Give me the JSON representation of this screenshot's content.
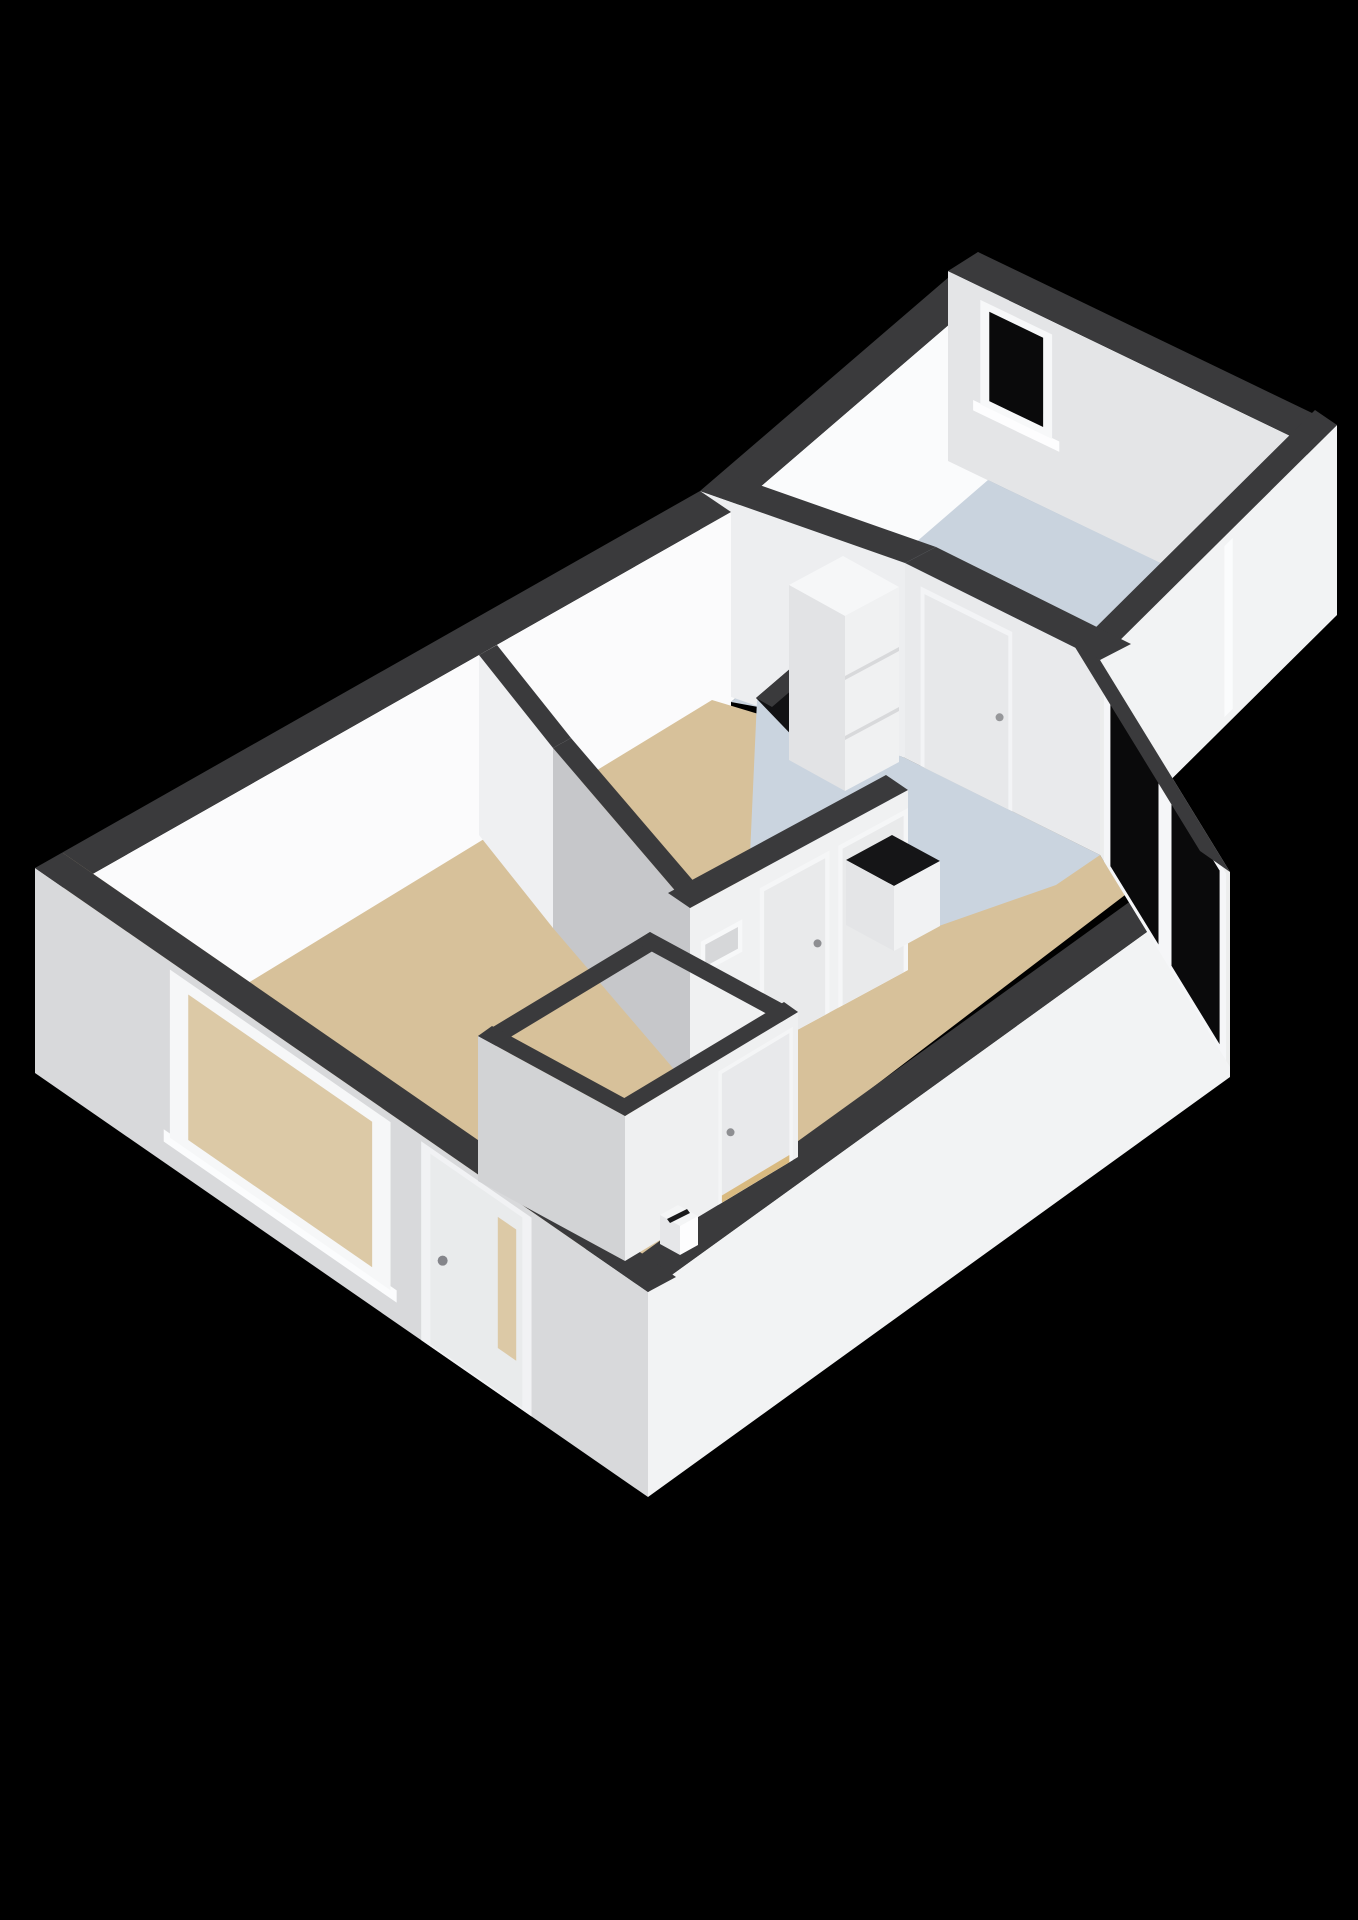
{
  "canvas": {
    "width": 1358,
    "height": 1920,
    "background": "#000000"
  },
  "palette": {
    "wall_cut_band": "#3a3a3c",
    "wall_white_bright": "#fbfbfc",
    "wall_white": "#f2f3f4",
    "wall_gray_light": "#e4e5e7",
    "wall_gray_mid": "#c6c7ca",
    "floor_living_beige": "#d7c19a",
    "floor_kitchen_blue": "#cad4df",
    "floor_bedroom_blue": "#c9d3de",
    "floor_bathroom_dark": "#121214",
    "glass_dark": "#0a0a0b",
    "glass_beige_reflection": "#dcc9a6",
    "counter_black": "#151517",
    "threshold_oak": "#d9ba80"
  },
  "scene": {
    "items": [
      {
        "name": "background",
        "type": "poly",
        "fill": "#000000",
        "points": [
          [
            0,
            0
          ],
          [
            1358,
            0
          ],
          [
            1358,
            1920
          ],
          [
            0,
            1920
          ]
        ]
      },
      {
        "name": "bedroom-wall-nw",
        "type": "wall",
        "edge": [
          [
            700,
            491
          ],
          [
            978,
            252
          ]
        ],
        "band": [
          31,
          21
        ],
        "drop": 190,
        "faceEdge": "inner",
        "face": "#fafbfc"
      },
      {
        "name": "bedroom-wall-ne",
        "type": "wall",
        "edge": [
          [
            978,
            252
          ],
          [
            1337,
            425
          ]
        ],
        "band": [
          -30,
          19
        ],
        "drop": 190,
        "faceEdge": "inner",
        "face": "#e4e5e7",
        "decals": [
          {
            "kind": "quad",
            "name": "bedroom-window-sill",
            "u0": 0.07,
            "u1": 0.31,
            "z0": 0.33,
            "z1": 0.385,
            "fill": "#fdfdfe"
          },
          {
            "kind": "quad",
            "name": "bedroom-window-frame",
            "u0": 0.09,
            "u1": 0.29,
            "z0": 0.38,
            "z1": 0.93,
            "fill": "#f7f8f9"
          },
          {
            "kind": "quad",
            "name": "bedroom-window-glass",
            "u0": 0.115,
            "u1": 0.265,
            "z0": 0.42,
            "z1": 0.89,
            "fill": "#0a0a0b"
          }
        ]
      },
      {
        "name": "bedroom-floor",
        "type": "poly",
        "fill": "#c9d3de",
        "points": [
          [
            731,
            702
          ],
          [
            988,
            480
          ],
          [
            1300,
            630
          ],
          [
            1115,
            835
          ],
          [
            940,
            740
          ]
        ]
      },
      {
        "name": "bedroom-wall-se",
        "type": "wall",
        "edge": [
          [
            1337,
            425
          ],
          [
            1100,
            660
          ]
        ],
        "band": [
          -22,
          -15
        ],
        "drop": 190,
        "faceEdge": "outer",
        "face": "#f2f3f4",
        "decals": [
          {
            "kind": "quad",
            "name": "bedroom-exterior-door-seam",
            "u0": 0.44,
            "u1": 0.475,
            "z0": 0.05,
            "z1": 0.95,
            "fill": "#fbfcfd"
          }
        ]
      },
      {
        "name": "bedroom-wall-sw",
        "type": "wall",
        "edge": [
          [
            700,
            491
          ],
          [
            905,
            563
          ]
        ],
        "band": [
          31,
          -16
        ],
        "drop": 195,
        "faceEdge": "outer",
        "face": "#edeef0"
      },
      {
        "name": "main-wall-nw",
        "type": "wall",
        "edge": [
          [
            35,
            868
          ],
          [
            700,
            491
          ]
        ],
        "band": [
          31,
          21
        ],
        "drop": 205,
        "faceEdge": "inner",
        "face": "#fbfbfc"
      },
      {
        "name": "living-room-floor",
        "type": "poly",
        "fill": "#d7c19a",
        "points": [
          [
            66,
            1094
          ],
          [
            712,
            700
          ],
          [
            905,
            758
          ],
          [
            1100,
            855
          ],
          [
            1125,
            895
          ],
          [
            640,
            1265
          ]
        ]
      },
      {
        "name": "living-room-floor-edge",
        "type": "poly",
        "fill": "#d7c19a",
        "points": [
          [
            66,
            1094
          ],
          [
            640,
            1265
          ],
          [
            676,
            1277
          ],
          [
            63,
            853
          ]
        ]
      },
      {
        "name": "kitchen-floor",
        "type": "poly",
        "fill": "#cad4df",
        "points": [
          [
            757,
            700
          ],
          [
            905,
            758
          ],
          [
            1100,
            855
          ],
          [
            1056,
            885
          ],
          [
            856,
            955
          ],
          [
            750,
            855
          ]
        ]
      },
      {
        "name": "bathroom-floor",
        "type": "poly",
        "fill": "#121214",
        "points": [
          [
            756,
            698
          ],
          [
            812,
            650
          ],
          [
            850,
            700
          ],
          [
            806,
            750
          ]
        ]
      },
      {
        "name": "main-wall-se",
        "type": "wall",
        "edge": [
          [
            1230,
            872
          ],
          [
            648,
            1292
          ]
        ],
        "band": [
          -30,
          -21
        ],
        "drop": 205,
        "faceEdge": "outer",
        "face": "#f2f3f4"
      },
      {
        "name": "main-wall-sw",
        "type": "wall",
        "edge": [
          [
            35,
            868
          ],
          [
            648,
            1292
          ]
        ],
        "band": [
          28,
          -15
        ],
        "drop": 205,
        "faceEdge": "outer",
        "face": "#d8d9db",
        "decals": [
          {
            "kind": "quad",
            "name": "living-window-sill",
            "u0": 0.21,
            "u1": 0.59,
            "z0": 0.1,
            "z1": 0.16,
            "fill": "#fbfcfd"
          },
          {
            "kind": "quad",
            "name": "living-window-frame",
            "u0": 0.22,
            "u1": 0.58,
            "z0": 0.14,
            "z1": 0.96,
            "fill": "#f6f7f8"
          },
          {
            "kind": "quad",
            "name": "living-window-glass",
            "u0": 0.25,
            "u1": 0.55,
            "z0": 0.19,
            "z1": 0.9,
            "fill": "#dcc9a6"
          },
          {
            "kind": "quad",
            "name": "front-door-frame",
            "u0": 0.63,
            "u1": 0.81,
            "z0": 0,
            "z1": 0.97,
            "fill": "#f1f2f4"
          },
          {
            "kind": "quad",
            "name": "front-door",
            "u0": 0.645,
            "u1": 0.795,
            "z0": 0.01,
            "z1": 0.94,
            "fill": "#e9ebec"
          },
          {
            "kind": "quad",
            "name": "front-door-glass",
            "u0": 0.755,
            "u1": 0.785,
            "z0": 0.22,
            "z1": 0.86,
            "fill": "#dcc9a6"
          },
          {
            "kind": "dot",
            "name": "front-door-handle",
            "u": 0.665,
            "z": 0.46,
            "r": 5,
            "fill": "#84858a"
          }
        ]
      },
      {
        "name": "vestibule-wall",
        "type": "wall",
        "edge": [
          [
            479,
            655
          ],
          [
            553,
            748
          ]
        ],
        "band": [
          18,
          -10
        ],
        "drop": 180,
        "faceEdge": "outer",
        "face": "#eff0f2"
      },
      {
        "name": "wc-wall-sw",
        "type": "wall",
        "edge": [
          [
            553,
            748
          ],
          [
            690,
            908
          ]
        ],
        "band": [
          18,
          -10
        ],
        "drop": 180,
        "faceEdge": "outer",
        "face": "#c6c7ca"
      },
      {
        "name": "wc-wall-se",
        "type": "wall",
        "edge": [
          [
            690,
            908
          ],
          [
            908,
            790
          ]
        ],
        "band": [
          -22,
          -15
        ],
        "drop": 180,
        "faceEdge": "outer",
        "face": "#f0f1f2",
        "decals": [
          {
            "kind": "quad",
            "name": "wc-transom-frame",
            "u0": 0.05,
            "u1": 0.24,
            "z0": 0.6,
            "z1": 0.78,
            "fill": "#f7f8f9"
          },
          {
            "kind": "quad",
            "name": "wc-transom-glass",
            "u0": 0.07,
            "u1": 0.22,
            "z0": 0.63,
            "z1": 0.75,
            "fill": "#d6d7d9"
          },
          {
            "kind": "quad",
            "name": "wc-door-frame",
            "u0": 0.32,
            "u1": 0.64,
            "z0": 0,
            "z1": 0.9,
            "fill": "#f5f6f7"
          },
          {
            "kind": "quad",
            "name": "wc-door",
            "u0": 0.34,
            "u1": 0.62,
            "z0": 0,
            "z1": 0.87,
            "fill": "#e9eaeb"
          },
          {
            "kind": "dot",
            "name": "wc-door-handle",
            "u": 0.585,
            "z": 0.42,
            "r": 4,
            "fill": "#8e8f92"
          },
          {
            "kind": "quad",
            "name": "bathroom-door-frame",
            "u0": 0.68,
            "u1": 1.0,
            "z0": 0,
            "z1": 0.9,
            "fill": "#f5f6f7"
          },
          {
            "kind": "quad",
            "name": "bathroom-door",
            "u0": 0.7,
            "u1": 0.98,
            "z0": 0,
            "z1": 0.87,
            "fill": "#e9eaeb"
          },
          {
            "kind": "dot",
            "name": "bathroom-door-handle",
            "u": 0.945,
            "z": 0.42,
            "r": 4,
            "fill": "#8e8f92"
          }
        ]
      },
      {
        "name": "bathroom-divider-wall",
        "type": "wall",
        "edge": [
          [
            756,
            698
          ],
          [
            812,
            650
          ]
        ],
        "band": [
          16,
          9
        ],
        "drop": 0,
        "faceEdge": "outer",
        "face": null
      },
      {
        "name": "kitchen-bedroom-wall",
        "type": "wall",
        "edge": [
          [
            905,
            563
          ],
          [
            1100,
            660
          ]
        ],
        "band": [
          31,
          -16
        ],
        "drop": 195,
        "faceEdge": "outer",
        "face": "#e9eaec",
        "decals": [
          {
            "kind": "quad",
            "name": "bedroom-door-frame",
            "u0": 0.08,
            "u1": 0.55,
            "z0": 0,
            "z1": 0.92,
            "fill": "#f3f4f6"
          },
          {
            "kind": "quad",
            "name": "bedroom-door",
            "u0": 0.1,
            "u1": 0.53,
            "z0": 0,
            "z1": 0.89,
            "fill": "#e7e8ea"
          },
          {
            "kind": "dot",
            "name": "bedroom-door-handle",
            "u": 0.485,
            "z": 0.45,
            "r": 4,
            "fill": "#96979a"
          }
        ]
      },
      {
        "name": "balcony-glass-wall",
        "type": "wall",
        "edge": [
          [
            1100,
            660
          ],
          [
            1230,
            872
          ]
        ],
        "band": [
          -30,
          -21
        ],
        "drop": 195,
        "faceEdge": "outer",
        "face": "#eceded",
        "decals": [
          {
            "kind": "quad",
            "name": "balcony-door-frame",
            "u0": 0.03,
            "u1": 0.97,
            "z0": 0,
            "z1": 0.96,
            "fill": "#f5f6f8"
          },
          {
            "kind": "quad",
            "name": "balcony-glass-left",
            "u0": 0.08,
            "u1": 0.45,
            "z0": 0.03,
            "z1": 0.92,
            "fill": "#0a0a0b"
          },
          {
            "kind": "quad",
            "name": "balcony-glass-right",
            "u0": 0.55,
            "u1": 0.92,
            "z0": 0.03,
            "z1": 0.92,
            "fill": "#0a0a0b"
          }
        ]
      },
      {
        "name": "kitchen-cabinet-top",
        "type": "poly",
        "fill": "#f6f7f8",
        "points": [
          [
            789,
            585
          ],
          [
            843,
            556
          ],
          [
            899,
            587
          ],
          [
            845,
            616
          ]
        ]
      },
      {
        "name": "kitchen-cabinet-side",
        "type": "poly",
        "fill": "#e2e3e5",
        "points": [
          [
            789,
            585
          ],
          [
            845,
            616
          ],
          [
            845,
            791
          ],
          [
            789,
            760
          ]
        ]
      },
      {
        "name": "kitchen-cabinet-front",
        "type": "poly",
        "fill": "#f0f1f2",
        "points": [
          [
            845,
            616
          ],
          [
            899,
            587
          ],
          [
            899,
            762
          ],
          [
            845,
            791
          ]
        ]
      },
      {
        "name": "kitchen-cabinet-seam-upper",
        "type": "poly",
        "fill": "#d8d9db",
        "points": [
          [
            845,
            676
          ],
          [
            899,
            647
          ],
          [
            899,
            651
          ],
          [
            845,
            680
          ]
        ]
      },
      {
        "name": "kitchen-cabinet-seam-lower",
        "type": "poly",
        "fill": "#d8d9db",
        "points": [
          [
            845,
            736
          ],
          [
            899,
            707
          ],
          [
            899,
            711
          ],
          [
            845,
            740
          ]
        ]
      },
      {
        "name": "kitchen-counter-top",
        "type": "poly",
        "fill": "#151517",
        "points": [
          [
            846,
            860
          ],
          [
            892,
            835
          ],
          [
            940,
            861
          ],
          [
            894,
            886
          ]
        ]
      },
      {
        "name": "kitchen-counter-side",
        "type": "poly",
        "fill": "#e4e5e7",
        "points": [
          [
            846,
            860
          ],
          [
            894,
            886
          ],
          [
            894,
            951
          ],
          [
            846,
            925
          ]
        ]
      },
      {
        "name": "kitchen-counter-front",
        "type": "poly",
        "fill": "#f1f2f3",
        "points": [
          [
            894,
            886
          ],
          [
            940,
            861
          ],
          [
            940,
            926
          ],
          [
            894,
            951
          ]
        ]
      },
      {
        "name": "hall-wall-nw",
        "type": "wall",
        "edge": [
          [
            478,
            1036
          ],
          [
            650,
            932
          ]
        ],
        "band": [
          16,
          11
        ],
        "drop": 0,
        "faceEdge": "outer",
        "face": null
      },
      {
        "name": "hall-wall-ne",
        "type": "wall",
        "edge": [
          [
            650,
            932
          ],
          [
            798,
            1012
          ]
        ],
        "band": [
          -16,
          10
        ],
        "drop": 0,
        "faceEdge": "outer",
        "face": null
      },
      {
        "name": "hall-wall-se",
        "type": "wall",
        "edge": [
          [
            625,
            1116
          ],
          [
            798,
            1012
          ]
        ],
        "band": [
          -14,
          -10
        ],
        "drop": 145,
        "faceEdge": "outer",
        "face": "#eff0f1",
        "decals": [
          {
            "kind": "quad",
            "name": "hall-door-frame",
            "u0": 0.54,
            "u1": 0.97,
            "z0": 0,
            "z1": 0.92,
            "fill": "#f4f5f6"
          },
          {
            "kind": "quad",
            "name": "hall-door",
            "u0": 0.56,
            "u1": 0.95,
            "z0": 0.05,
            "z1": 0.89,
            "fill": "#e8e9eb"
          },
          {
            "kind": "quad",
            "name": "hall-door-threshold",
            "u0": 0.56,
            "u1": 0.95,
            "z0": 0,
            "z1": 0.05,
            "fill": "#d9ba80"
          },
          {
            "kind": "dot",
            "name": "hall-door-handle",
            "u": 0.61,
            "z": 0.45,
            "r": 4,
            "fill": "#8e8f92"
          }
        ]
      },
      {
        "name": "hall-wall-sw",
        "type": "wall",
        "edge": [
          [
            478,
            1036
          ],
          [
            625,
            1116
          ]
        ],
        "band": [
          14,
          -10
        ],
        "drop": 145,
        "faceEdge": "outer",
        "face": "#d2d3d5"
      },
      {
        "name": "letterbox-top",
        "type": "poly",
        "fill": "#f4f5f6",
        "points": [
          [
            660,
            1215
          ],
          [
            678,
            1205
          ],
          [
            698,
            1216
          ],
          [
            680,
            1226
          ]
        ]
      },
      {
        "name": "letterbox-front",
        "type": "poly",
        "fill": "#fdfdfe",
        "points": [
          [
            680,
            1226
          ],
          [
            698,
            1216
          ],
          [
            698,
            1245
          ],
          [
            680,
            1255
          ]
        ]
      },
      {
        "name": "letterbox-side",
        "type": "poly",
        "fill": "#e6e7e9",
        "points": [
          [
            660,
            1215
          ],
          [
            680,
            1226
          ],
          [
            680,
            1255
          ],
          [
            660,
            1244
          ]
        ]
      },
      {
        "name": "letterbox-slot",
        "type": "poly",
        "fill": "#1a1a1c",
        "points": [
          [
            667,
            1219
          ],
          [
            687,
            1209
          ],
          [
            690,
            1213
          ],
          [
            670,
            1223
          ]
        ]
      }
    ]
  }
}
